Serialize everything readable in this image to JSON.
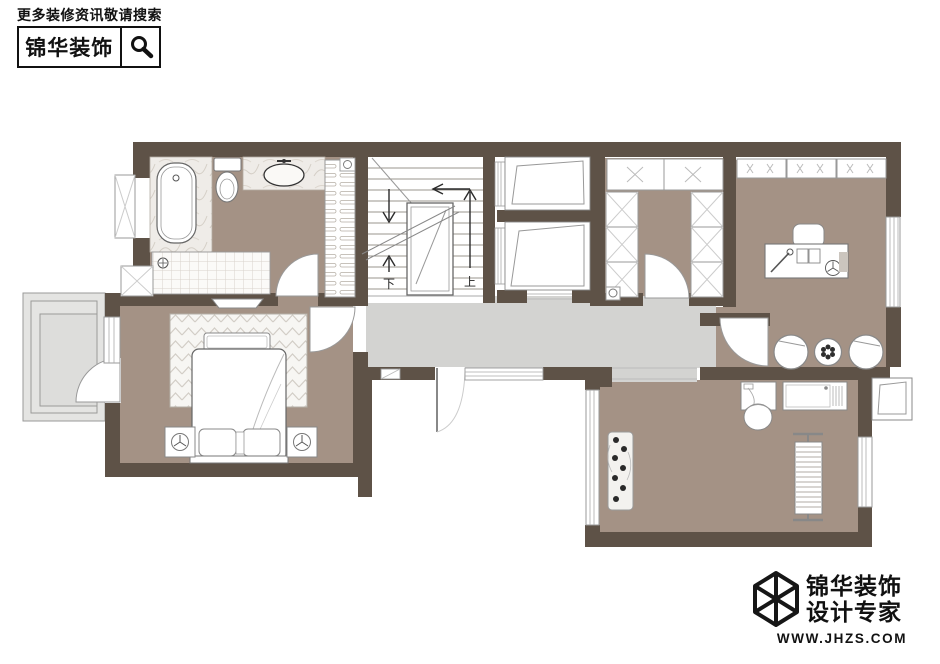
{
  "header": {
    "tagline": "更多装修资讯敬请搜索",
    "brand": "锦华装饰",
    "search_icon": "magnifier"
  },
  "stairs": {
    "up_label": "上",
    "down_label": "下"
  },
  "footer": {
    "brand": "锦华装饰",
    "subtitle": "设计专家",
    "website": "WWW.JHZS.COM",
    "logo_icon": "wireframe-cube"
  },
  "colors": {
    "wall": "#5e5247",
    "room_floor": "#a49285",
    "corridor_floor": "#d3d3d1",
    "balcony_floor": "#dddddb",
    "brand_black": "#111111"
  }
}
